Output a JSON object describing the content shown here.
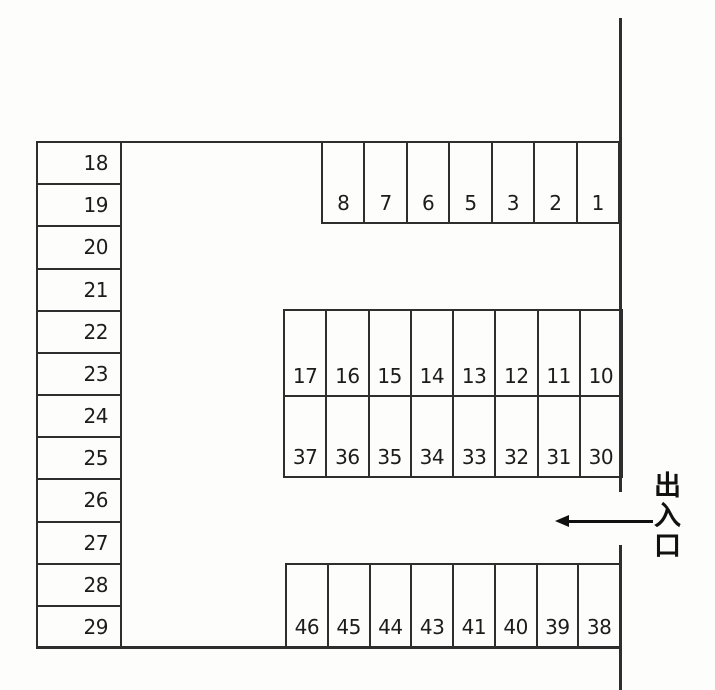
{
  "lot": {
    "left_column": [
      "18",
      "19",
      "20",
      "21",
      "22",
      "23",
      "24",
      "25",
      "26",
      "27",
      "28",
      "29"
    ],
    "top_row": [
      "8",
      "7",
      "6",
      "5",
      "3",
      "2",
      "1"
    ],
    "island_upper_row": [
      "17",
      "16",
      "15",
      "14",
      "13",
      "12",
      "11",
      "10"
    ],
    "island_lower_row": [
      "37",
      "36",
      "35",
      "34",
      "33",
      "32",
      "31",
      "30"
    ],
    "bottom_row": [
      "46",
      "45",
      "44",
      "43",
      "41",
      "40",
      "39",
      "38"
    ]
  },
  "entrance": {
    "label": "出入口",
    "arrow_icon": "arrow-left"
  },
  "colors": {
    "line": "#2e2e2e",
    "text": "#1c1c1c",
    "bg": "#fdfdfc"
  }
}
